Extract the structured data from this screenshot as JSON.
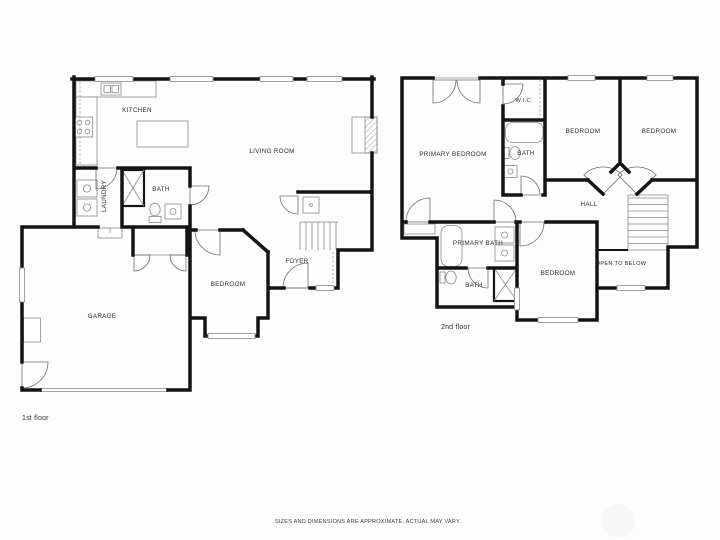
{
  "page": {
    "disclaimer": "SIZES AND DIMENSIONS ARE APPROXIMATE, ACTUAL MAY VARY.",
    "background": "#fdfdfd",
    "wall_color": "#141414",
    "fixture_line_color": "#8a8a8a",
    "label_color": "#2b2b2b"
  },
  "floor1": {
    "caption": "1st floor",
    "rooms": {
      "kitchen": "KITCHEN",
      "living_room": "LIVING ROOM",
      "bath": "BATH",
      "laundry": "LAUNDRY",
      "bedroom": "BEDROOM",
      "foyer": "FOYER",
      "garage": "GARAGE"
    },
    "fixtures": [
      "kitchen-sink",
      "stove",
      "kitchen-island",
      "counter",
      "washer",
      "dryer",
      "shower",
      "toilet",
      "vanity-sink",
      "fireplace",
      "staircase",
      "stair-closet",
      "entry-door",
      "garage-door",
      "utility-box",
      "garage-closet-double-doors"
    ]
  },
  "floor2": {
    "caption": "2nd floor",
    "rooms": {
      "primary_bedroom": "PRIMARY BEDROOM",
      "wic": "W.I.C.",
      "bath_upper": "BATH",
      "bedroom_left": "BEDROOM",
      "bedroom_right": "BEDROOM",
      "hall": "HALL",
      "primary_bath": "PRIMARY BATH",
      "bath_lower": "BATH",
      "bedroom_bottom": "BEDROOM",
      "open_to_below": "OPEN TO BELOW"
    },
    "fixtures": [
      "bathtub",
      "toilet",
      "vanity-sink",
      "primary-bathtub",
      "double-vanity",
      "shower",
      "staircase",
      "closet-double-doors",
      "wic-rod",
      "linen-shelf"
    ]
  }
}
